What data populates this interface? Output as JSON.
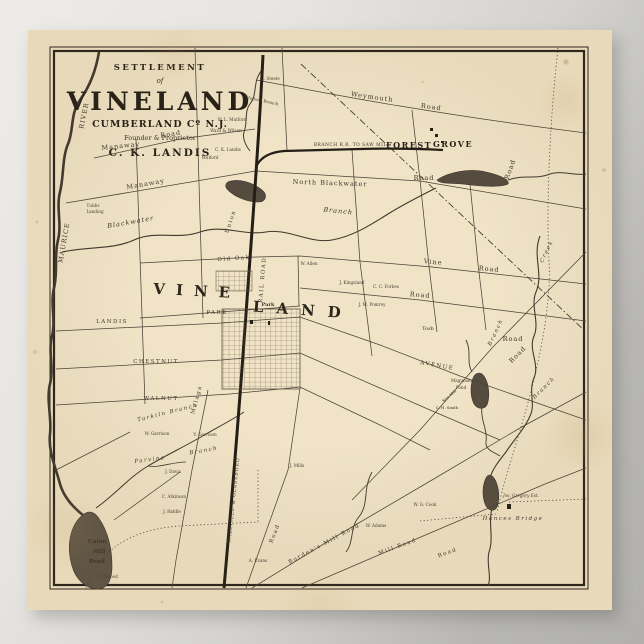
{
  "colors": {
    "paper": "#f0e3c6",
    "ink": "#3a3127",
    "background_gray": "#b4b3b1"
  },
  "poster": {
    "title": [
      "SETTLEMENT",
      "of",
      "VINELAND",
      "CUMBERLAND Cº N.J.",
      "Founder & Proprietor",
      "C. K. LANDIS"
    ]
  },
  "map": {
    "big_name_west": "VINE",
    "big_name_east": "LAND",
    "railroads": {
      "main": "MILLVILLE & GLASSBORO",
      "main_rail_road": "RAIL ROAD",
      "branch": "BRANCH R.R. TO SAW MILL"
    },
    "places": {
      "forest": "FOREST",
      "grove": "GROVE",
      "park_square": "Park",
      "union_pond_1": "Union",
      "union_pond_2": "Mill",
      "union_pond_3": "Pond",
      "tubbs_1": "Tubbs",
      "tubbs_2": "Landing",
      "hances_bridge": "Hances Bridge",
      "gregory_estate": "Jos. Gregory Est.",
      "magunshe_1": "Magunshe",
      "magunshe_2": "Pond",
      "saw_mill": "Saw Mill"
    },
    "waterways": {
      "river_word": "RIVER",
      "maurice_word": "MAURICE",
      "blackwater": "Blackwater",
      "hudson_branch": "Hudson Branch",
      "tarkiln_branch": "Tarkiln Branch",
      "parvins": "Parvins",
      "branch_mid": "Branch",
      "branch_south": "Branch",
      "branch_east1": "Branch",
      "branch_east2": "Branch",
      "creek": "Creek"
    },
    "roads": {
      "weymouth": "Weymouth",
      "weymouth_road": "Road",
      "manaway1": "Manaway",
      "manaway1_road": "Road",
      "manaway2": "Manaway",
      "north_blackwater": "North Blackwater",
      "north_blackwater_road": "Road",
      "union": "Union",
      "old_oak": "Old Oak",
      "vine": "Vine",
      "vine_road": "Road",
      "road_e2": "Road",
      "road_e3": "Road",
      "road_e4": "Road",
      "road_right_vert": "Road",
      "park_ave": "PARK",
      "landis_ave": "LANDIS",
      "chestnut_ave": "CHESTNUT",
      "walnut_ave": "WALNUT",
      "avenue": "AVENUE",
      "malaga": "Malaga",
      "road_sw": "Road",
      "bordens_mill": "Borden's Mill Road",
      "mill_road": "Mill Road",
      "road_s2": "Road"
    },
    "owners": {
      "j_steele": "J. Steele",
      "wl_mulford": "W. L. Mulford",
      "ward_wilson": "Ward & Wilson",
      "ck_landis": "C. K. Landis",
      "mulford": "Mulford",
      "w_allen": "W. Allen",
      "j_kingsland": "J. Kingsland",
      "cc_forbes": "C. C. Forbes",
      "jm_pomroy": "J. M. Pomroy",
      "tosh": "Tosh",
      "w_garrison": "W. Garrison",
      "v_garrison": "V. Garrison",
      "j_davis": "J. Davis",
      "c_atkinson": "C. Atkinson",
      "j_riddle": "J. Riddle",
      "j_elwood": "J. Elwood",
      "a_evans": "A. Evans",
      "j_mills": "J. Mills",
      "w_adams": "W. Adams",
      "wg_cook": "W. G. Cook",
      "ch_smith": "C. H. Smith"
    }
  }
}
